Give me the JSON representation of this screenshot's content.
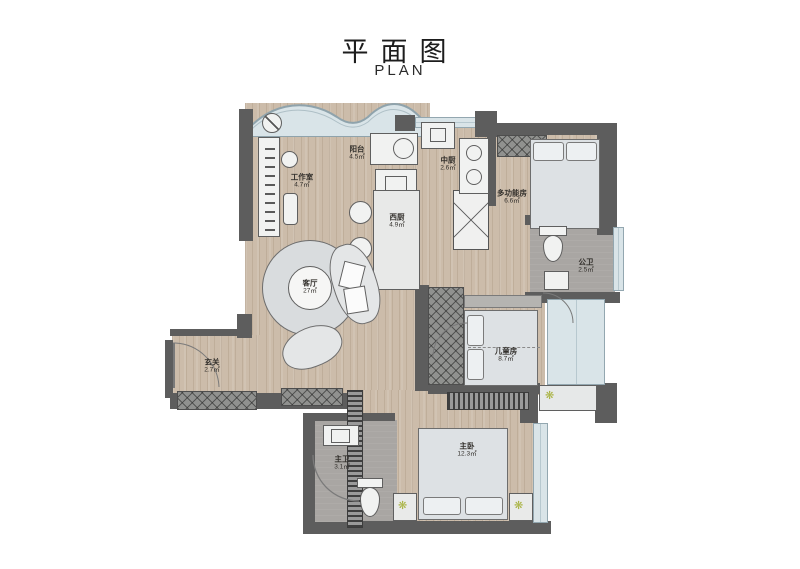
{
  "title": {
    "zh": "平面图",
    "en": "PLAN"
  },
  "rooms": [
    {
      "id": "studio",
      "name": "工作室",
      "area": "4.7㎡"
    },
    {
      "id": "balcony",
      "name": "阳台",
      "area": "4.5㎡"
    },
    {
      "id": "kitchen-cn",
      "name": "中厨",
      "area": "2.6㎡"
    },
    {
      "id": "multi-room",
      "name": "多功能房",
      "area": "6.6㎡"
    },
    {
      "id": "kitchen-west",
      "name": "西厨",
      "area": "4.9㎡"
    },
    {
      "id": "bath-public",
      "name": "公卫",
      "area": "2.5㎡"
    },
    {
      "id": "living",
      "name": "客厅",
      "area": "27㎡"
    },
    {
      "id": "entry",
      "name": "玄关",
      "area": "2.7㎡"
    },
    {
      "id": "kids-room",
      "name": "儿童房",
      "area": "8.7㎡"
    },
    {
      "id": "master-bed",
      "name": "主卧",
      "area": "12.3㎡"
    },
    {
      "id": "bath-master",
      "name": "主卫",
      "area": "3.1㎡"
    }
  ],
  "colors": {
    "wall": "#5d5d5d",
    "wood_floor": "#ccbcaa",
    "tile_floor": "#a9a6a3",
    "window": "#d9e4e8",
    "furniture": "#f1f2f1",
    "accent_plant": "#a8b23f",
    "text": "#33302c"
  }
}
